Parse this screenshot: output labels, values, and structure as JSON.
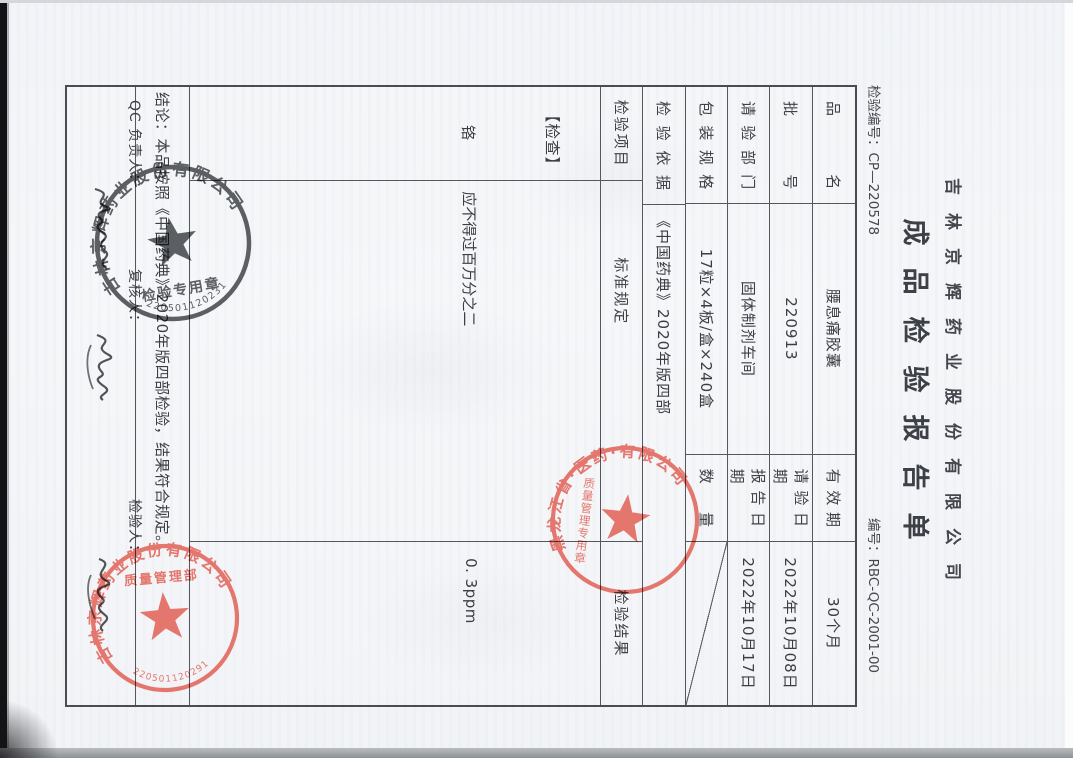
{
  "scan": {
    "exam_no_label": "检验编号：",
    "exam_no": "CP—220578",
    "doc_no_label": "编号：",
    "doc_no": "RBC-QC-2001-00",
    "company_name": "吉林京辉药业股份有限公司",
    "report_title": "成品检验报告单"
  },
  "table": {
    "rows": [
      {
        "label": "品名",
        "value": "腰息痛胶囊",
        "label2": "有效期",
        "value2": "30个月"
      },
      {
        "label": "批号",
        "value": "220913",
        "label2": "请验日期",
        "value2": "2022年10月08日"
      },
      {
        "label": "请验部门",
        "value": "固体制剂车间",
        "label2": "报告日期",
        "value2": "2022年10月17日"
      },
      {
        "label": "包装规格",
        "value": "17粒×4板/盒×240盒",
        "label2": "数量",
        "value2": ""
      },
      {
        "label": "检验依据",
        "value": "《中国药典》2020年版四部"
      }
    ],
    "header": {
      "item": "检验项目",
      "standard": "标准规定",
      "result": "检验结果"
    },
    "content": {
      "section": "【检查】",
      "item": "铬",
      "standard": "应不得过百万分之二",
      "result": "0. 3ppm"
    },
    "conclusion": "结论：本品按照《中国药典》2020年版四部检验，结果符合规定。",
    "signers": {
      "qc": "QC 负责人：",
      "reviewer": "复核人：",
      "inspector": "检验人："
    }
  },
  "stamps": {
    "black_seal": {
      "ring_text": "吉林京辉药业股份有限公司",
      "serial": "2205011202310",
      "inner_text": "检验专用章",
      "color": "#4a4d52"
    },
    "red_seal_middle": {
      "ring_text": "黑龙江省·医药·有限公司",
      "inner_text": "质量管理专用章",
      "color": "#e0564a"
    },
    "red_seal_bottom": {
      "ring_text": "吉林京辉药业股份有限公司",
      "serial": "2205011202910",
      "inner_text": "质量管理部",
      "color": "#e0564a"
    }
  }
}
